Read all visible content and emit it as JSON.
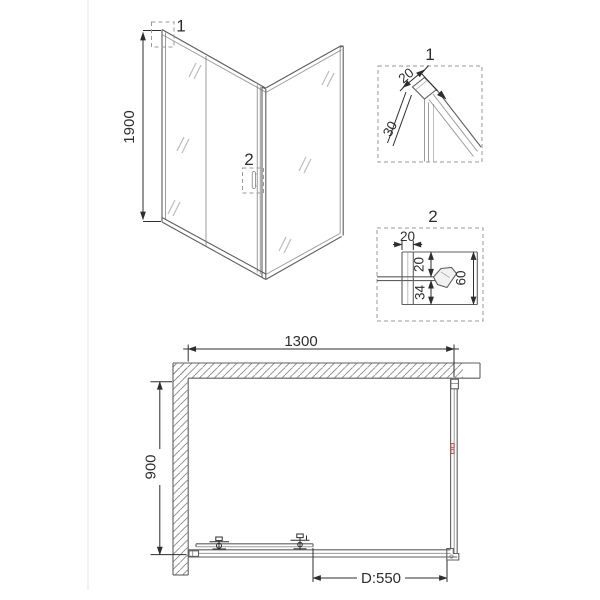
{
  "drawing": {
    "perspective_view": {
      "callout_profile": "1",
      "callout_handle": "2",
      "height_dim": "1900"
    },
    "detail_profile": {
      "label": "1",
      "width_dim": "20",
      "depth_dim": "30"
    },
    "detail_handle": {
      "label": "2",
      "top_width_dim": "20",
      "upper_dim": "20",
      "lower_dim": "34",
      "total_height_dim": "60"
    },
    "plan_view": {
      "width_dim": "1300",
      "depth_dim": "900",
      "door_dim": "D:550"
    }
  },
  "colors": {
    "line": "#5f5f5f",
    "dimension": "#2e2e2e",
    "hatch": "#8a8a8a",
    "glass_mark": "#c0c0c0",
    "dashed_box": "#9a9a9a",
    "accent_red": "#b0524b",
    "background": "#ffffff",
    "page_border": "#e9e9e9"
  }
}
